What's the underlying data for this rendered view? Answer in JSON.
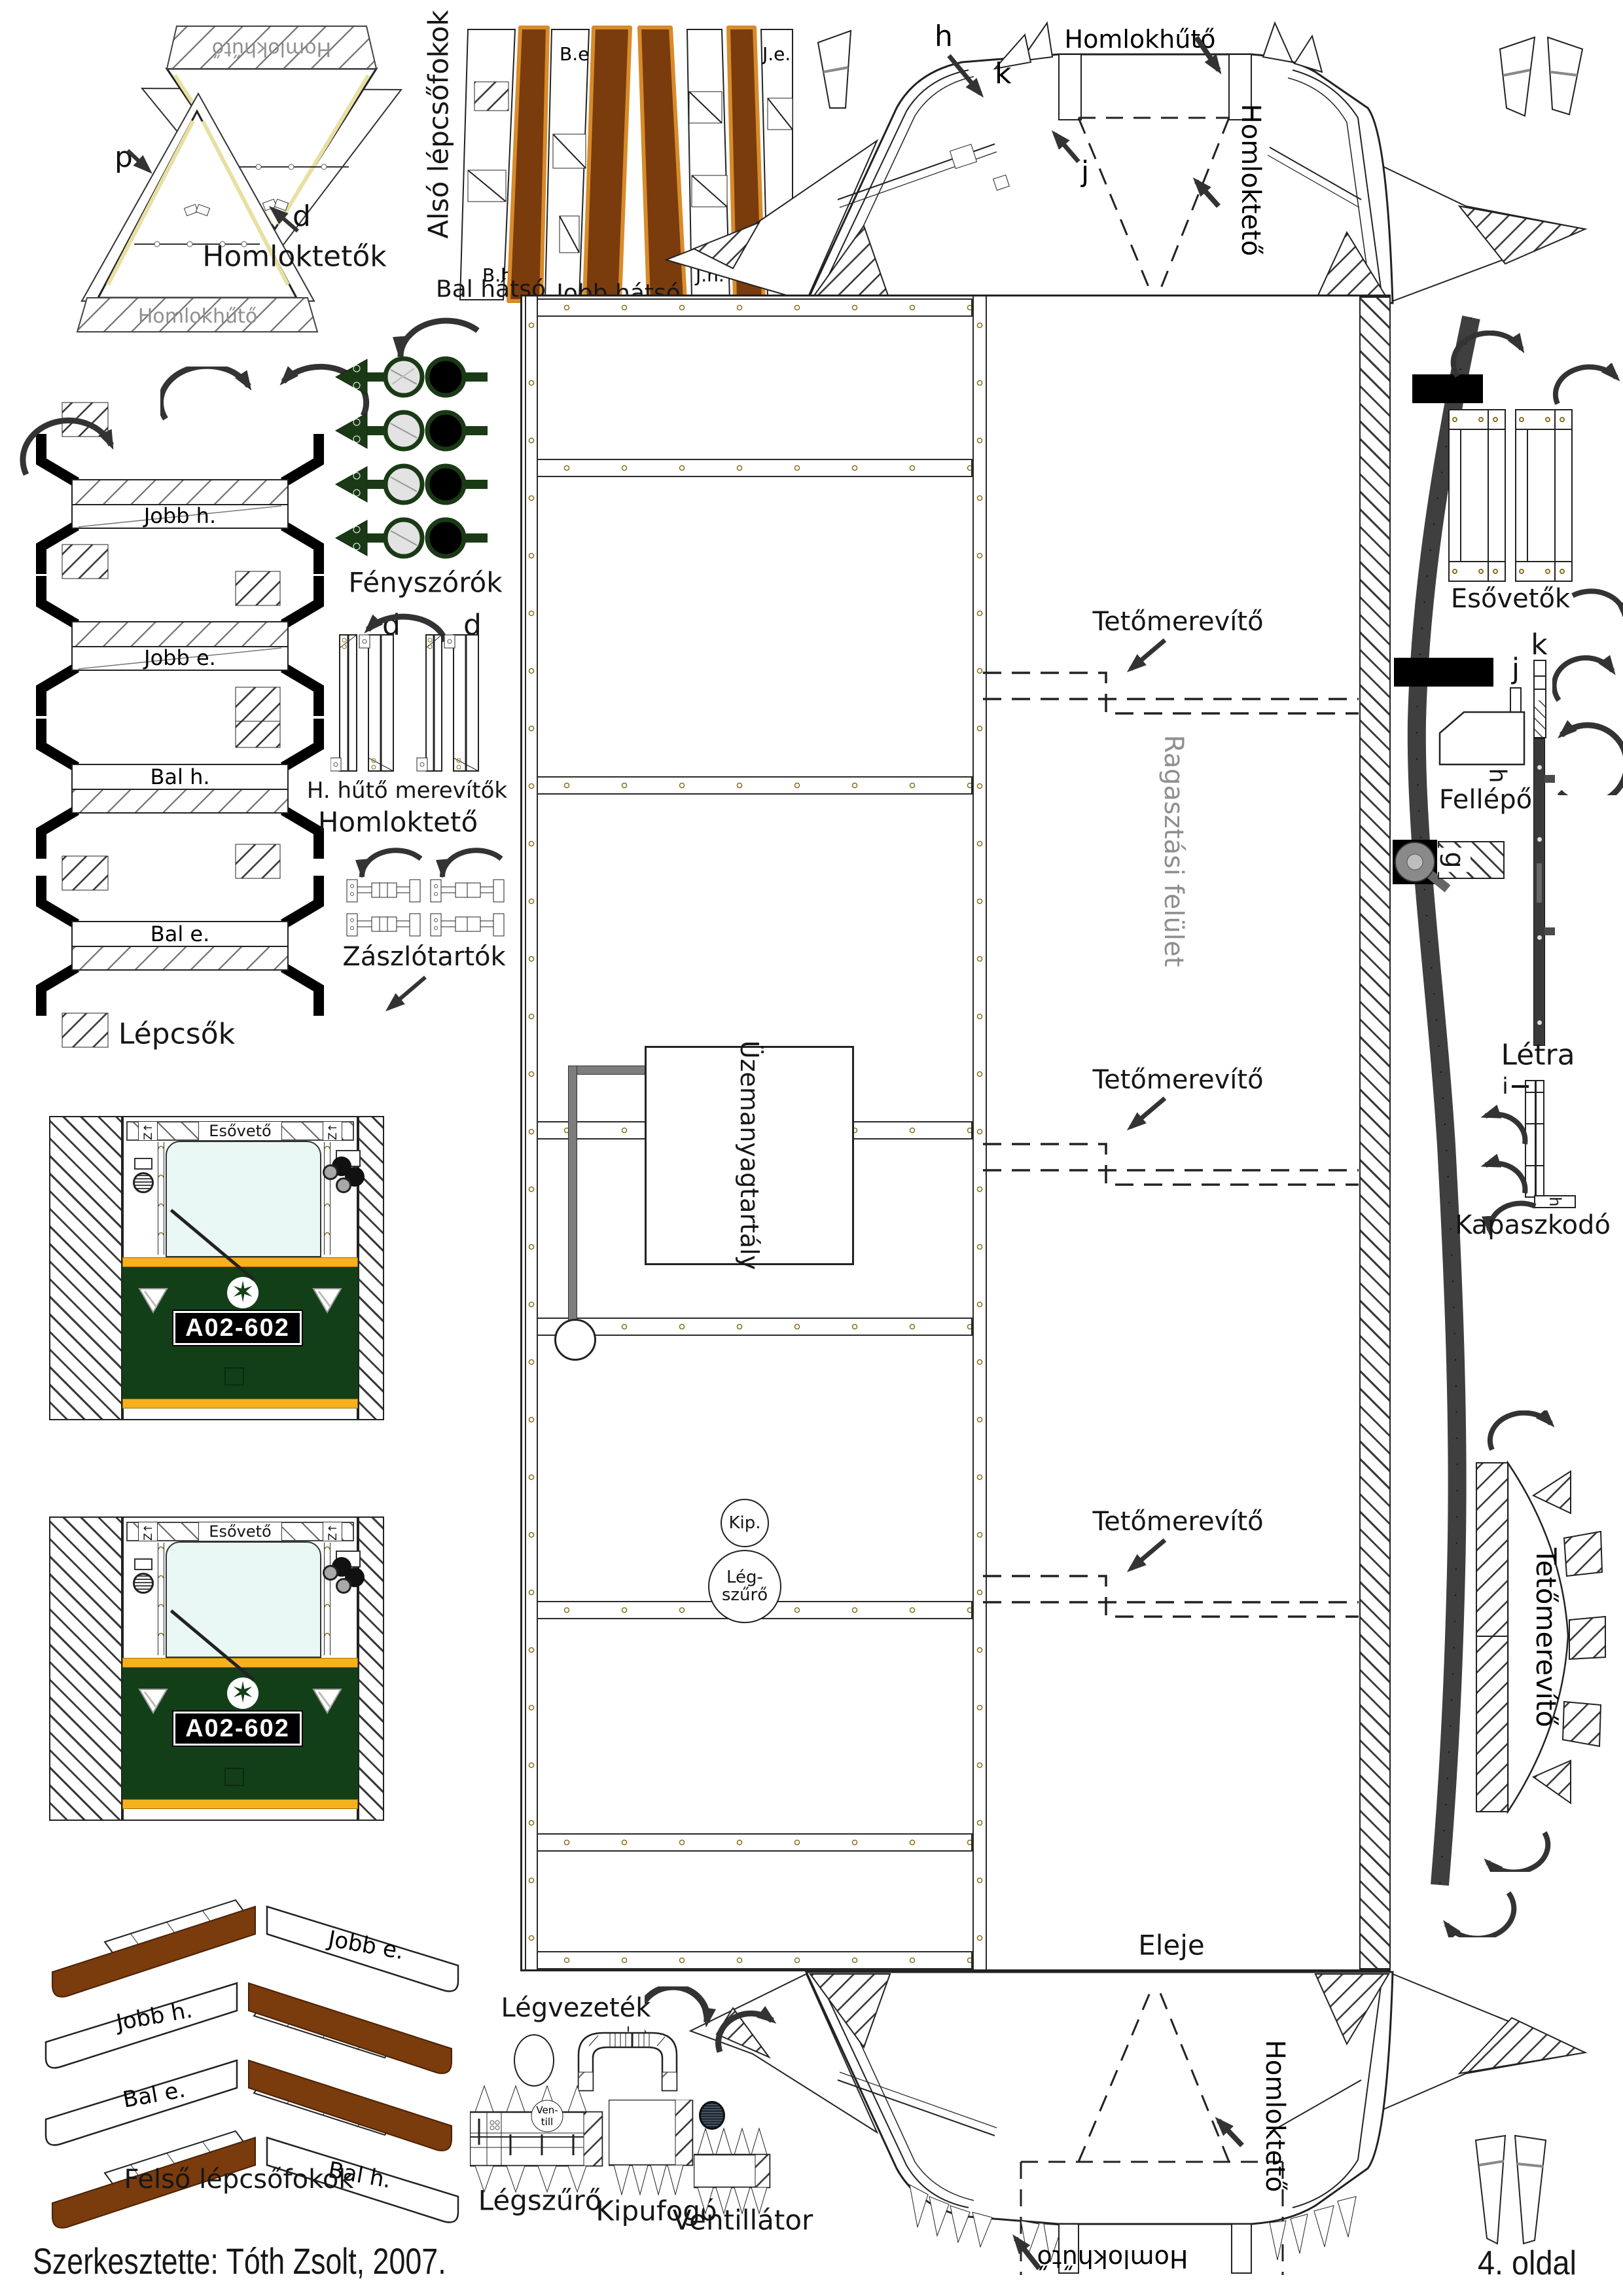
{
  "page": {
    "footer": "Szerkesztette: Tóth Zsolt, 2007.",
    "page_number": "4. oldal"
  },
  "labels": {
    "homloktetok": "Homloktetők",
    "homlokhuto": "Homlokhűtő",
    "homlokteto": "Homloktető",
    "also_lepcsofokok": "Alsó lépcsőfokok",
    "bal_hatso": "Bal hátsó",
    "jobb_hatso": "Jobb hátsó",
    "be": "B.e.",
    "je": "J.e.",
    "bh": "B.h.",
    "jh": "J.h.",
    "hatulja": "Hátulja",
    "eleje": "Eleje",
    "jobb_h": "Jobb h.",
    "jobb_e": "Jobb e.",
    "bal_h": "Bal h.",
    "bal_e": "Bal e.",
    "lepcsok": "Lépcsők",
    "fenyszorok": "Fényszórók",
    "h_huto_merevitok": "H. hűtő merevítők",
    "zaszlotartok": "Zászlótartók",
    "esoveto": "Esővető",
    "z_mark": "Z↑",
    "plate": "A02-602",
    "tetomerevito": "Tetőmerevítő",
    "ragasztasi_felulet": "Ragasztási felület",
    "uzemanyagtartaly": "Üzemanyagtartály",
    "esovetok": "Esővetők",
    "fellepo": "Fellépő",
    "letra": "Létra",
    "kapaszkodo": "Kapaszkodó",
    "kip": "Kip.",
    "leg": "Lég-",
    "szuro": "szűrő",
    "felso_lepcsofokok": "Felső lépcsőfokok",
    "legvezetek": "Légvezeték",
    "legszuro": "Légszűrő",
    "kipufogo": "Kipufogó",
    "ventillator": "Ventillátor",
    "ven": "Ven-",
    "till": "till",
    "p": "p",
    "d": "d",
    "h": "h",
    "k": "k",
    "j": "j",
    "i": "i",
    "g": "g"
  },
  "colors": {
    "brown": "#7a3b0d",
    "brown_border": "#d78b2a",
    "cab_green": "#123f18",
    "lamp_green": "#1a3a16",
    "orange": "#f7b01e",
    "window": "#e9f8f5",
    "gray_text": "#8f8f8f",
    "dark_strip": "#3f3f3f"
  }
}
